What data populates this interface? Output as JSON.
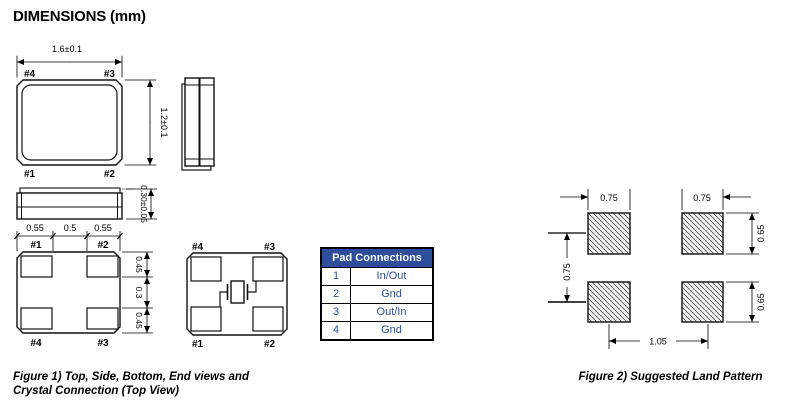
{
  "title": "DIMENSIONS (mm)",
  "figure1": {
    "caption_line1": "Figure 1) Top, Side, Bottom, End views and",
    "caption_line2": "Crystal Connection (Top View)",
    "top_view": {
      "width_dim": "1.6±0.1",
      "height_dim": "1.2±0.1",
      "pad_top_left": "#4",
      "pad_top_right": "#3",
      "pad_bottom_left": "#1",
      "pad_bottom_right": "#2"
    },
    "side_view": {
      "height_dim": "0.30±0.05"
    },
    "bottom_view": {
      "top_dims": [
        "0.55",
        "0.5",
        "0.55"
      ],
      "right_dims": [
        "0.45",
        "0.3",
        "0.45"
      ],
      "pad_top_left": "#1",
      "pad_top_right": "#2",
      "pad_bottom_left": "#4",
      "pad_bottom_right": "#3"
    },
    "crystal_view": {
      "pad_top_left": "#4",
      "pad_top_right": "#3",
      "pad_bottom_left": "#1",
      "pad_bottom_right": "#2"
    }
  },
  "pad_table": {
    "header": "Pad Connections",
    "rows": [
      {
        "pad": "1",
        "conn": "In/Out"
      },
      {
        "pad": "2",
        "conn": "Gnd"
      },
      {
        "pad": "3",
        "conn": "Out/In"
      },
      {
        "pad": "4",
        "conn": "Gnd"
      }
    ],
    "header_bg": "#2e4e9c",
    "text_color": "#2b4ea0"
  },
  "figure2": {
    "caption": "Figure 2) Suggested Land Pattern",
    "pad_width_left": "0.75",
    "pad_width_right": "0.75",
    "pad_height_top": "0.65",
    "pad_height_bottom": "0.65",
    "vertical_pitch": "0.75",
    "horizontal_pitch": "1.05"
  }
}
